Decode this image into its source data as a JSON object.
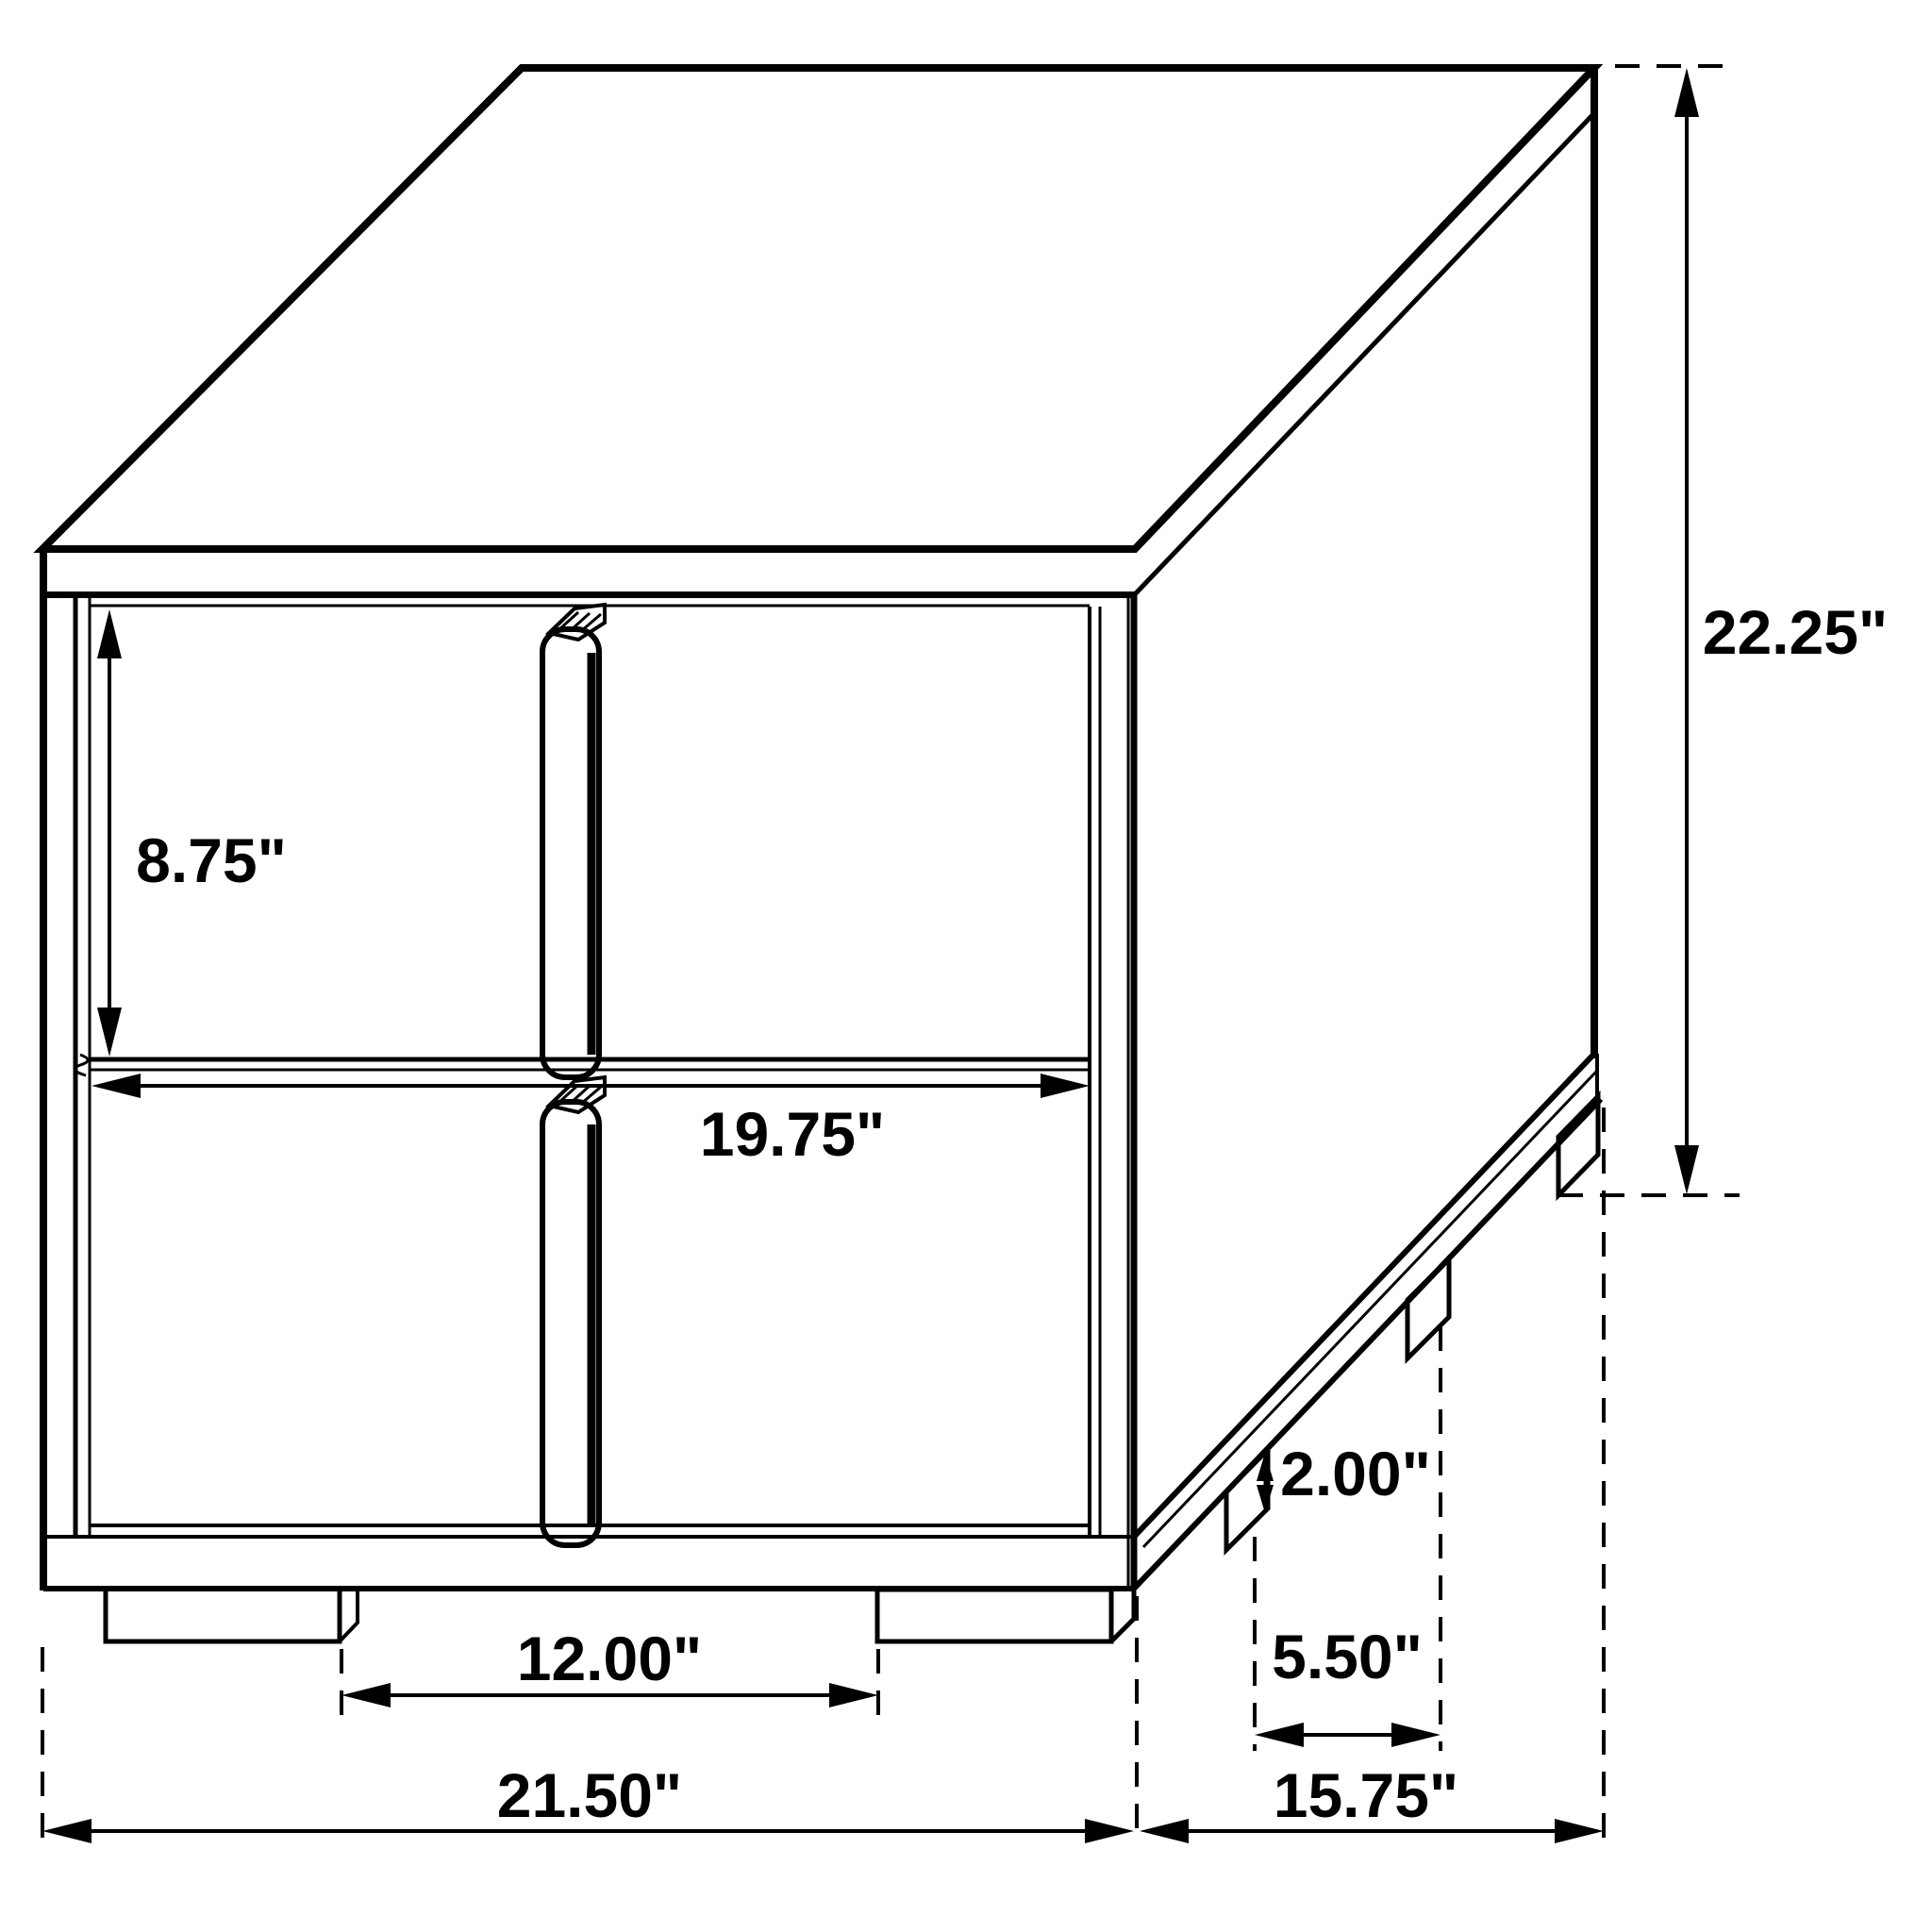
{
  "figure": {
    "kind": "furniture-dimension-drawing",
    "object": "two-drawer nightstand",
    "background_color": "#ffffff",
    "line_color": "#000000"
  },
  "dimensions": {
    "upper_drawer_height": "8.75\"",
    "drawer_width": "19.75\"",
    "overall_height": "22.25\"",
    "foot_height": "2.00\"",
    "front_feet_spacing": "12.00\"",
    "side_feet_spacing": "5.50\"",
    "overall_width": "21.50\"",
    "overall_depth": "15.75\""
  }
}
